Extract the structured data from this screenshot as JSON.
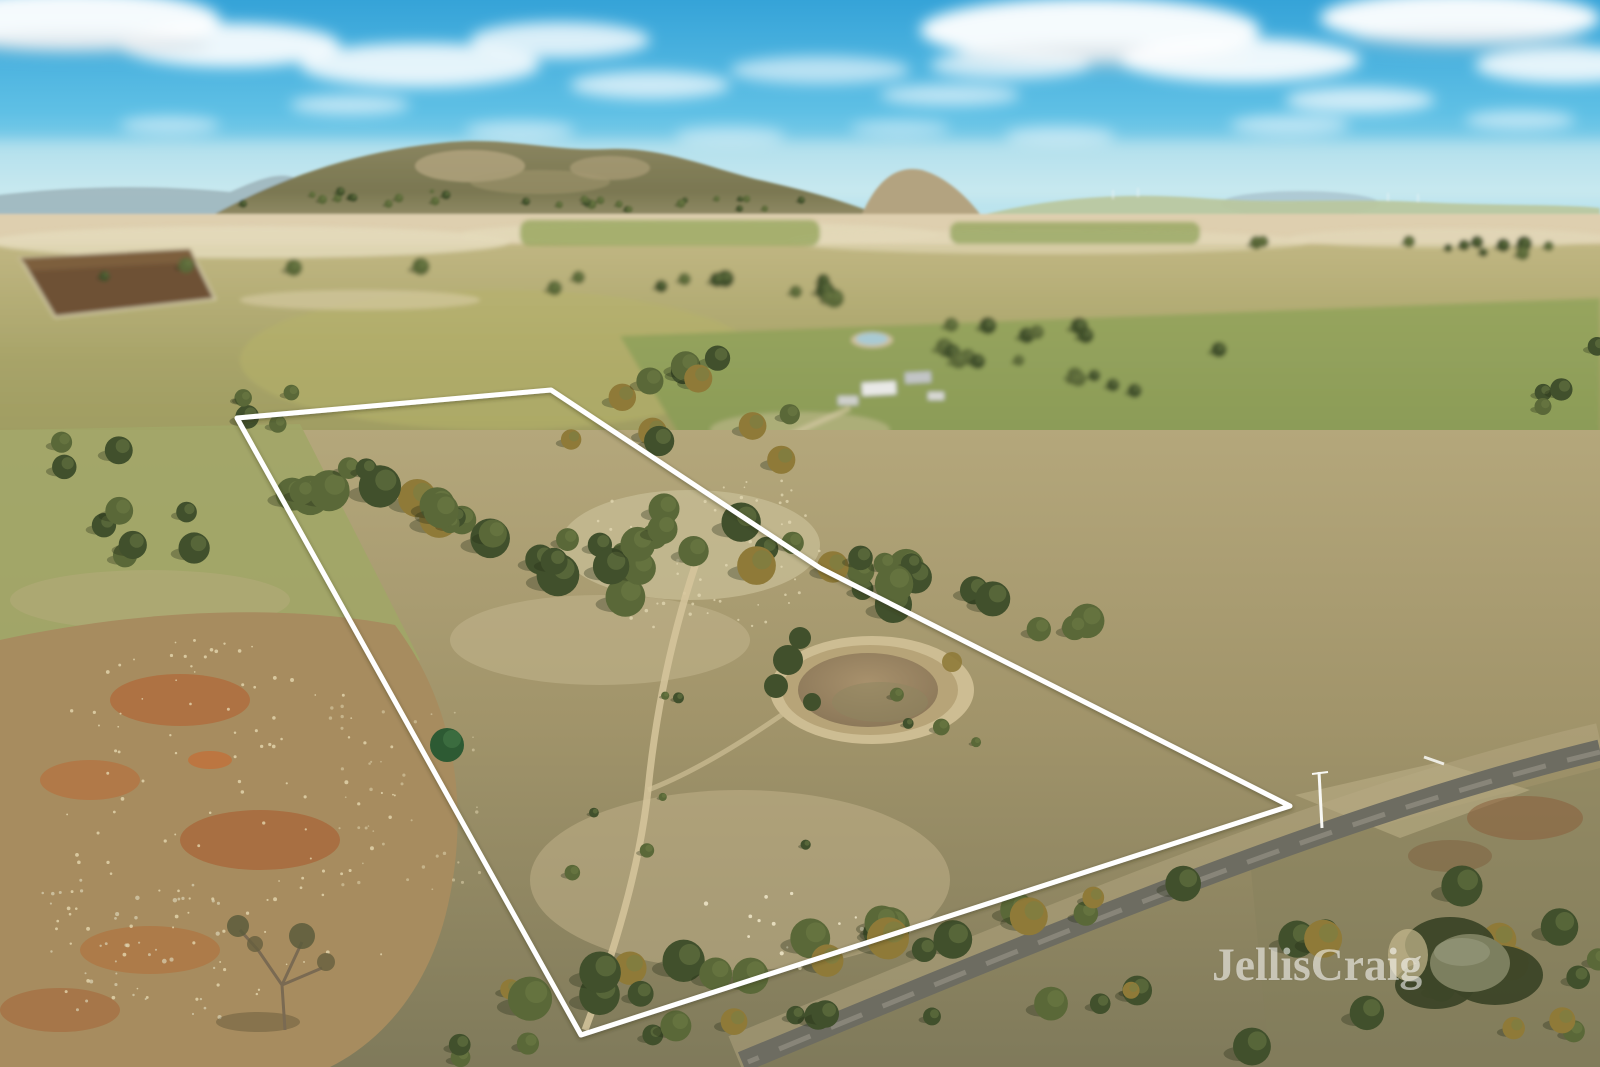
{
  "photo": {
    "kind": "aerial-drone-real-estate-photo",
    "width_px": 1600,
    "height_px": 1067,
    "scene": "Aerial view of rural acreage for sale: white property boundary outline over dry paddocks with scattered eucalypts, farm dams, a country road, green pastures, distant tree-covered hills and a blue sky with clouds"
  },
  "watermark": {
    "text": "JellisCraig",
    "color": "#ffffff",
    "opacity": 0.55
  },
  "boundary": {
    "stroke": "#ffffff",
    "stroke_width": 5,
    "path": "M 237 418 L 551 390 L 820 568 L 1290 806 L 581 1035 Z"
  },
  "palette": {
    "sky_top": "#35a3d8",
    "sky_mid": "#5fc0e5",
    "sky_low": "#a5dcec",
    "sky_horizon": "#ddeff0",
    "cloud": "#ffffff",
    "hills_far": "#9fb6bc",
    "hills_main_dark": "#7a7751",
    "hills_main_light": "#96906a",
    "hill_rock": "#b3a380",
    "hills_right": "#bac79d",
    "field_cream": "#e4dbbb",
    "plowed_field": "#6e5134",
    "field_yellow_green": "#b7b269",
    "pasture_green": "#7e9150",
    "foreground_tan": "#b2a478",
    "foreground_deep": "#837e5b",
    "dirt_orange": "#b06a3c",
    "tree_dark": "#41502c",
    "tree_mid": "#5a6838",
    "tree_amber": "#8f7a38",
    "tree_bright_pine": "#2d5a33",
    "water_muddy": "#a08a66",
    "water_reflective": "#edf0ed",
    "water_pond_dark": "#7c7f5f",
    "road": "#6d6c61",
    "gravel": "#b9ab85"
  },
  "landmarks": {
    "sheep": [
      [
        1015,
        497
      ],
      [
        1028,
        504
      ],
      [
        1047,
        506
      ],
      [
        1163,
        525
      ],
      [
        1178,
        526
      ],
      [
        1193,
        528
      ],
      [
        1205,
        534
      ],
      [
        1223,
        535
      ]
    ],
    "dams": [
      {
        "cx": 1361,
        "cy": 525,
        "type": "reflective-dam"
      },
      {
        "cx": 870,
        "cy": 690,
        "type": "muddy-dam-inside-boundary"
      },
      {
        "cx": 1470,
        "cy": 962,
        "type": "dark-pond-bottom-right"
      }
    ]
  }
}
